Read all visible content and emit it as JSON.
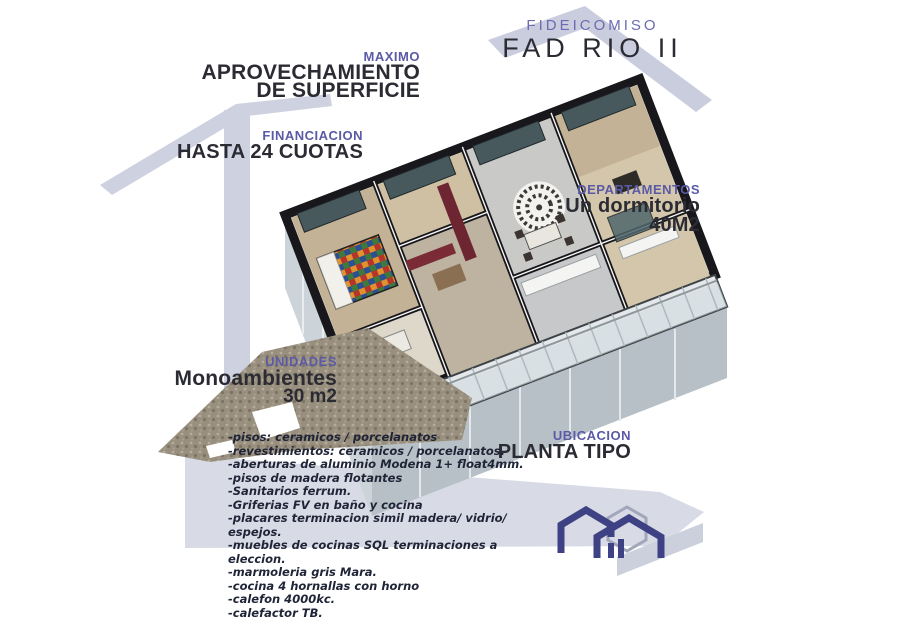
{
  "poster": {
    "title_kicker": "FIDEICOMISO",
    "title": "FAD RIO II"
  },
  "callouts": {
    "surface": {
      "kicker": "MAXIMO",
      "line1": "APROVECHAMIENTO",
      "line2": "DE SUPERFICIE"
    },
    "financing": {
      "kicker": "FINANCIACION",
      "line1": "HASTA 24 CUOTAS"
    },
    "apartments": {
      "kicker": "DEPARTAMENTOS",
      "line1": "Un dormitorio",
      "line2": "40M2"
    },
    "units": {
      "kicker": "UNIDADES",
      "line1": "Monoambientes",
      "line2": "30 m2"
    },
    "location": {
      "kicker": "UBICACION",
      "line1": "PLANTA TIPO"
    }
  },
  "features": {
    "items": [
      "-pisos: ceramicos / porcelanatos",
      "-revestimientos: ceramicos / porcelanatos.",
      "-aberturas de aluminio Modena 1+ float4mm.",
      "-pisos de madera flotantes",
      "-Sanitarios ferrum.",
      "-Griferias FV en baño y cocina",
      "-placares terminacion simil madera/ vidrio/ espejos.",
      "-muebles de cocinas SQL terminaciones a eleccion.",
      "-marmoleria gris Mara.",
      "-cocina 4 hornallas con horno",
      "-calefon 4000kc.",
      "-calefactor TB."
    ]
  },
  "icons": {
    "logo": "house-outline-logo",
    "artwork": "3d-floorplan-render"
  },
  "colors": {
    "accent_purple": "#5a5aa6",
    "heading_dark": "#2b2b33",
    "list_navy": "#1f2437",
    "band_gray": "#cdd1e0",
    "logo_navy": "#3e4183",
    "glass_teal": "#47595d",
    "maroon_wall": "#6d2631",
    "gravel": "#998f7e"
  }
}
